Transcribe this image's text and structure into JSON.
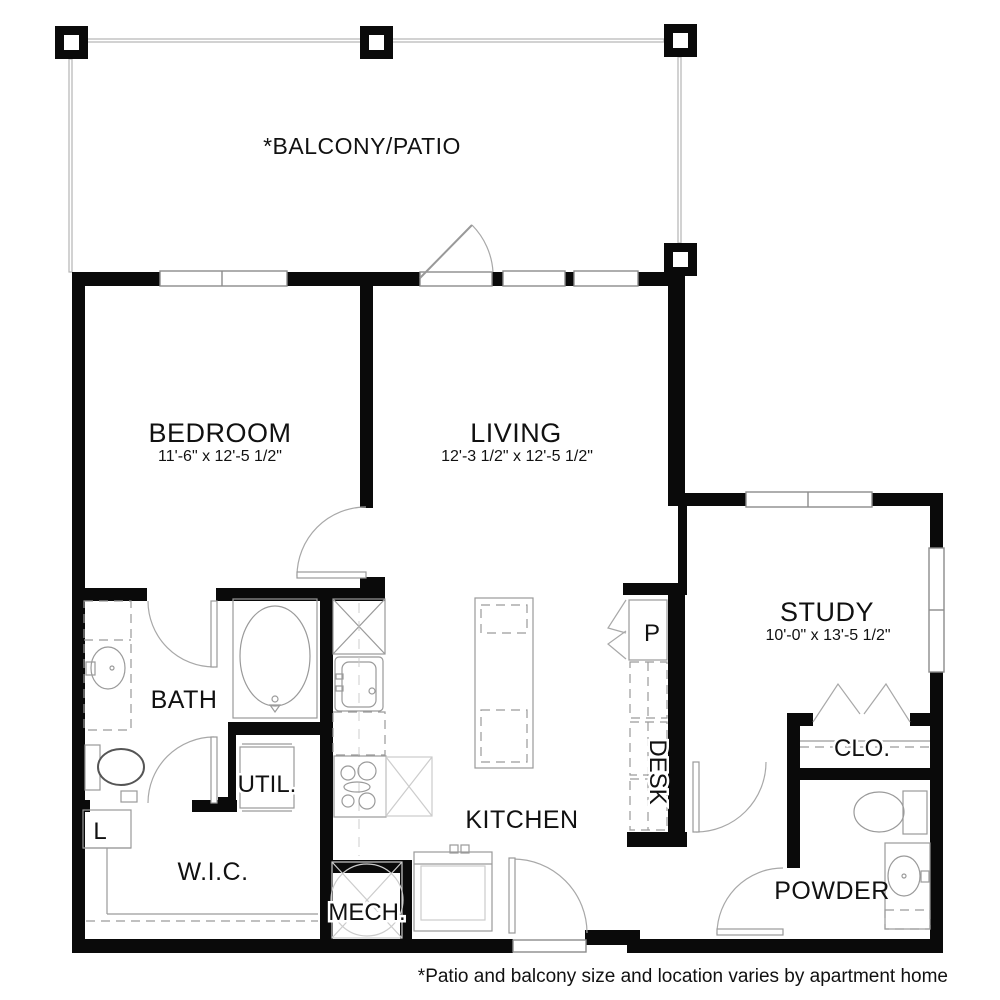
{
  "balcony": {
    "label": "*BALCONY/PATIO"
  },
  "rooms": {
    "bedroom": {
      "label": "BEDROOM",
      "dims": "11'-6\" x 12'-5 1/2\""
    },
    "living": {
      "label": "LIVING",
      "dims": "12'-3 1/2\" x 12'-5 1/2\""
    },
    "study": {
      "label": "STUDY",
      "dims": "10'-0\" x 13'-5 1/2\""
    },
    "bath": {
      "label": "BATH"
    },
    "utility": {
      "label": "UTIL."
    },
    "walk_in_closet": {
      "label": "W.I.C."
    },
    "mechanical": {
      "label": "MECH."
    },
    "kitchen": {
      "label": "KITCHEN"
    },
    "desk": {
      "label": "DESK"
    },
    "pantry": {
      "label": "P"
    },
    "linen": {
      "label": "L"
    },
    "closet": {
      "label": "CLO."
    },
    "powder": {
      "label": "POWDER"
    }
  },
  "footer": {
    "note": "*Patio and balcony size and location varies by apartment home"
  },
  "colors": {
    "wall": "#0a0a0a",
    "fixture_line": "#9a9a9a",
    "ghost_line": "#cccccc",
    "window_line": "#8c8c8c",
    "balcony_line": "#b5b5b5"
  }
}
